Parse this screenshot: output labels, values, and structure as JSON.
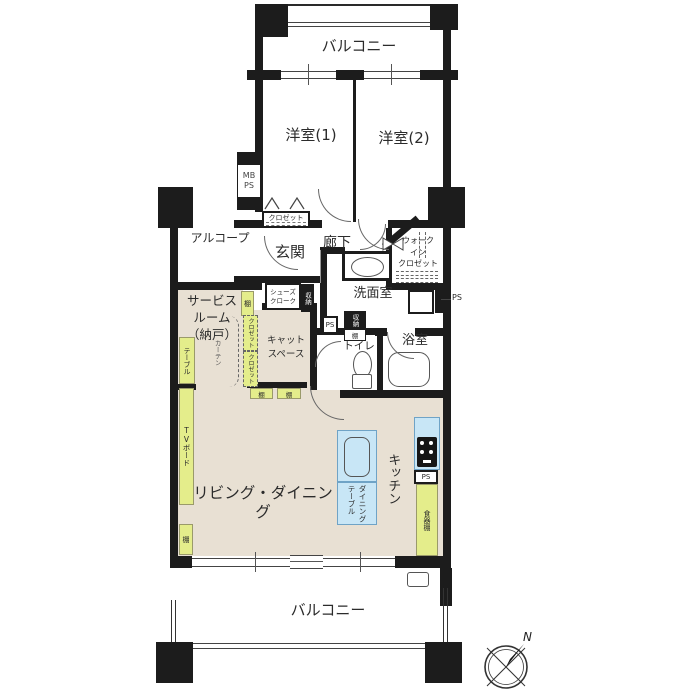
{
  "colors": {
    "wall": "#1c1c1c",
    "floor_beige": "#e8e0d3",
    "furniture_green": "#e4ed8b",
    "counter_blue": "#c8e6f6"
  },
  "labels": {
    "balcony_top": "バルコニー",
    "balcony_bottom": "バルコニー",
    "bedroom1": "洋室(1)",
    "bedroom2": "洋室(2)",
    "mb_ps": "MB\nPS",
    "closet": "クロゼット",
    "alcove": "アルコープ",
    "entrance": "玄関",
    "hallway": "廊下",
    "walk_in_closet": "ウォーク\nイン\nクロゼット",
    "washroom": "洗面室",
    "ps": "PS",
    "storage": "収納",
    "shelf": "棚",
    "toilet": "トイレ",
    "bathroom": "浴室",
    "service_room": "サービス\nルーム\n（納戸）",
    "shoe_cloak": "シューズ\nクローク",
    "table": "テーブル",
    "curtain": "カーテン",
    "cat_space": "キャット\nスペース",
    "tv_board": "TVボード",
    "living_dining": "リビング・ダイニング",
    "kitchen": "キッチン",
    "dining_table": "ダイニング\nテーブル",
    "cupboard": "食器棚",
    "compass_n": "N"
  }
}
